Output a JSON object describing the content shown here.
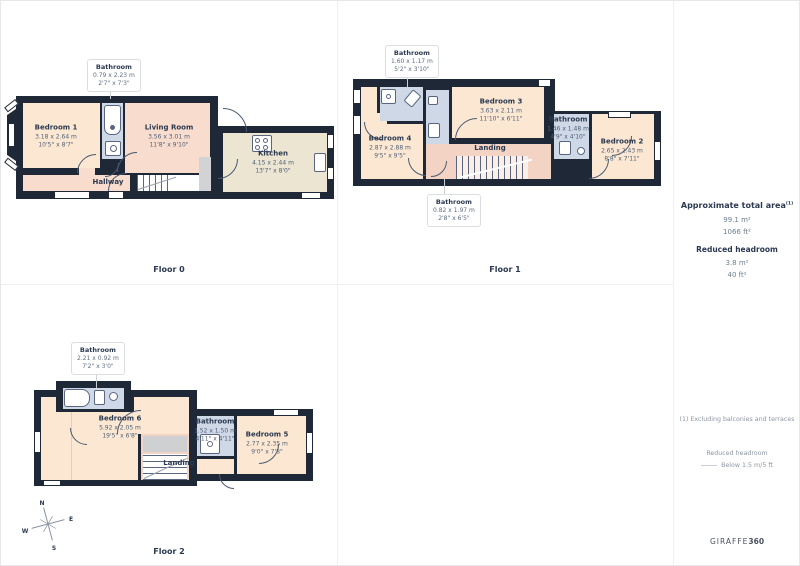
{
  "branding": {
    "name_line1": "PROPERTY",
    "name_line2": "FOUNDATIONS",
    "name_line3": "GROUP",
    "colors": {
      "orange": "#f2a33c",
      "teal": "#265672",
      "green": "#a7b94a",
      "maroon": "#7e2050",
      "red": "#e14f65",
      "navy": "#252c52"
    }
  },
  "sidebar": {
    "area_heading": "Approximate total area",
    "area_heading_sup": "(1)",
    "area_m2": "99.1 m²",
    "area_ft2": "1066 ft²",
    "reduced_heading": "Reduced headroom",
    "reduced_m2": "3.8 m²",
    "reduced_ft2": "40 ft²",
    "footnote": "(1) Excluding balconies and terraces",
    "legend_title": "Reduced headroom",
    "legend_item": "Below 1.5 m/5 ft",
    "disclaimer": "Calculations reference the RICS IPMS 3C standard. Measurements are approximate and not to scale. This floor plan is intended for illustration only.",
    "brand_mark": "GIRAFFE",
    "brand_mark_bold": "360"
  },
  "floor0": {
    "label": "Floor 0",
    "callout_bathroom": {
      "name": "Bathroom",
      "metric": "0.79 x 2.23 m",
      "imperial": "2'7\" x 7'3\""
    },
    "bedroom1": {
      "name": "Bedroom 1",
      "metric": "3.18 x 2.64 m",
      "imperial": "10'5\" x 8'7\""
    },
    "living_room": {
      "name": "Living Room",
      "metric": "3.56 x 3.01 m",
      "imperial": "11'8\" x 9'10\""
    },
    "kitchen": {
      "name": "Kitchen",
      "metric": "4.15 x 2.44 m",
      "imperial": "13'7\" x 8'0\""
    },
    "hallway": {
      "name": "Hallway"
    }
  },
  "floor1": {
    "label": "Floor 1",
    "callout_bathroom_top": {
      "name": "Bathroom",
      "metric": "1.60 x 1.17 m",
      "imperial": "5'2\" x 3'10\""
    },
    "callout_bathroom_bottom": {
      "name": "Bathroom",
      "metric": "0.82 x 1.97 m",
      "imperial": "2'8\" x 6'5\""
    },
    "bathroom_mid": {
      "name": "Bathroom",
      "metric": "1.46 x 1.48 m",
      "imperial": "4'9\" x 4'10\""
    },
    "bedroom3": {
      "name": "Bedroom 3",
      "metric": "3.63 x 2.11 m",
      "imperial": "11'10\" x 6'11\""
    },
    "bedroom4": {
      "name": "Bedroom 4",
      "metric": "2.87 x 2.88 m",
      "imperial": "9'5\" x 9'5\""
    },
    "bedroom2": {
      "name": "Bedroom 2",
      "metric": "2.65 x 2.43 m",
      "imperial": "8'8\" x 7'11\""
    },
    "landing": {
      "name": "Landing"
    }
  },
  "floor2": {
    "label": "Floor 2",
    "callout_bathroom": {
      "name": "Bathroom",
      "metric": "2.21 x 0.92 m",
      "imperial": "7'2\" x 3'0\""
    },
    "bathroom_mid": {
      "name": "Bathroom",
      "metric": "1.52 x 1.50 m",
      "imperial": "4'11\" x 4'11\""
    },
    "bedroom6": {
      "name": "Bedroom 6",
      "metric": "5.92 x 2.05 m",
      "imperial": "19'5\" x 6'8\""
    },
    "bedroom5": {
      "name": "Bedroom 5",
      "metric": "2.77 x 2.35 m",
      "imperial": "9'0\" x 7'8\""
    },
    "landing": {
      "name": "Landing"
    }
  },
  "compass": {
    "north": "N",
    "east": "E",
    "south": "S",
    "west": "W"
  }
}
